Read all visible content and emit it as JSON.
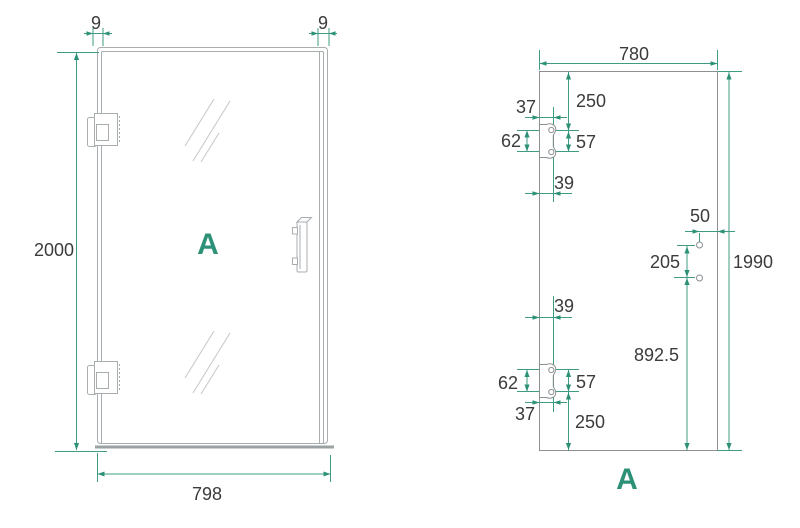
{
  "page": {
    "background": "#ffffff"
  },
  "colors": {
    "accent_teal": "#2d9178",
    "dimension_line_teal": "#3f9c82",
    "frame_gray": "#a8adaf",
    "glass_outline_gray": "#8b9093",
    "text": "#3b3b3b"
  },
  "front_view": {
    "label": "A",
    "dim_frame_left": "9",
    "dim_frame_right": "9",
    "dim_height": "2000",
    "dim_width": "798"
  },
  "glass_view": {
    "label": "A",
    "dim_width": "780",
    "dim_height": "1990",
    "top_hinge": {
      "from_top": "250",
      "hole_spacing": "57",
      "cutout_height": "62",
      "edge_to_holes": "37",
      "edge_to_holes_lower": "39"
    },
    "bottom_hinge": {
      "from_bottom": "250",
      "hole_spacing": "57",
      "cutout_height": "62",
      "edge_to_holes": "37",
      "edge_to_holes_upper": "39"
    },
    "handle": {
      "hole_to_edge": "50",
      "hole_spacing": "205",
      "lower_hole_to_bottom": "892.5"
    }
  }
}
